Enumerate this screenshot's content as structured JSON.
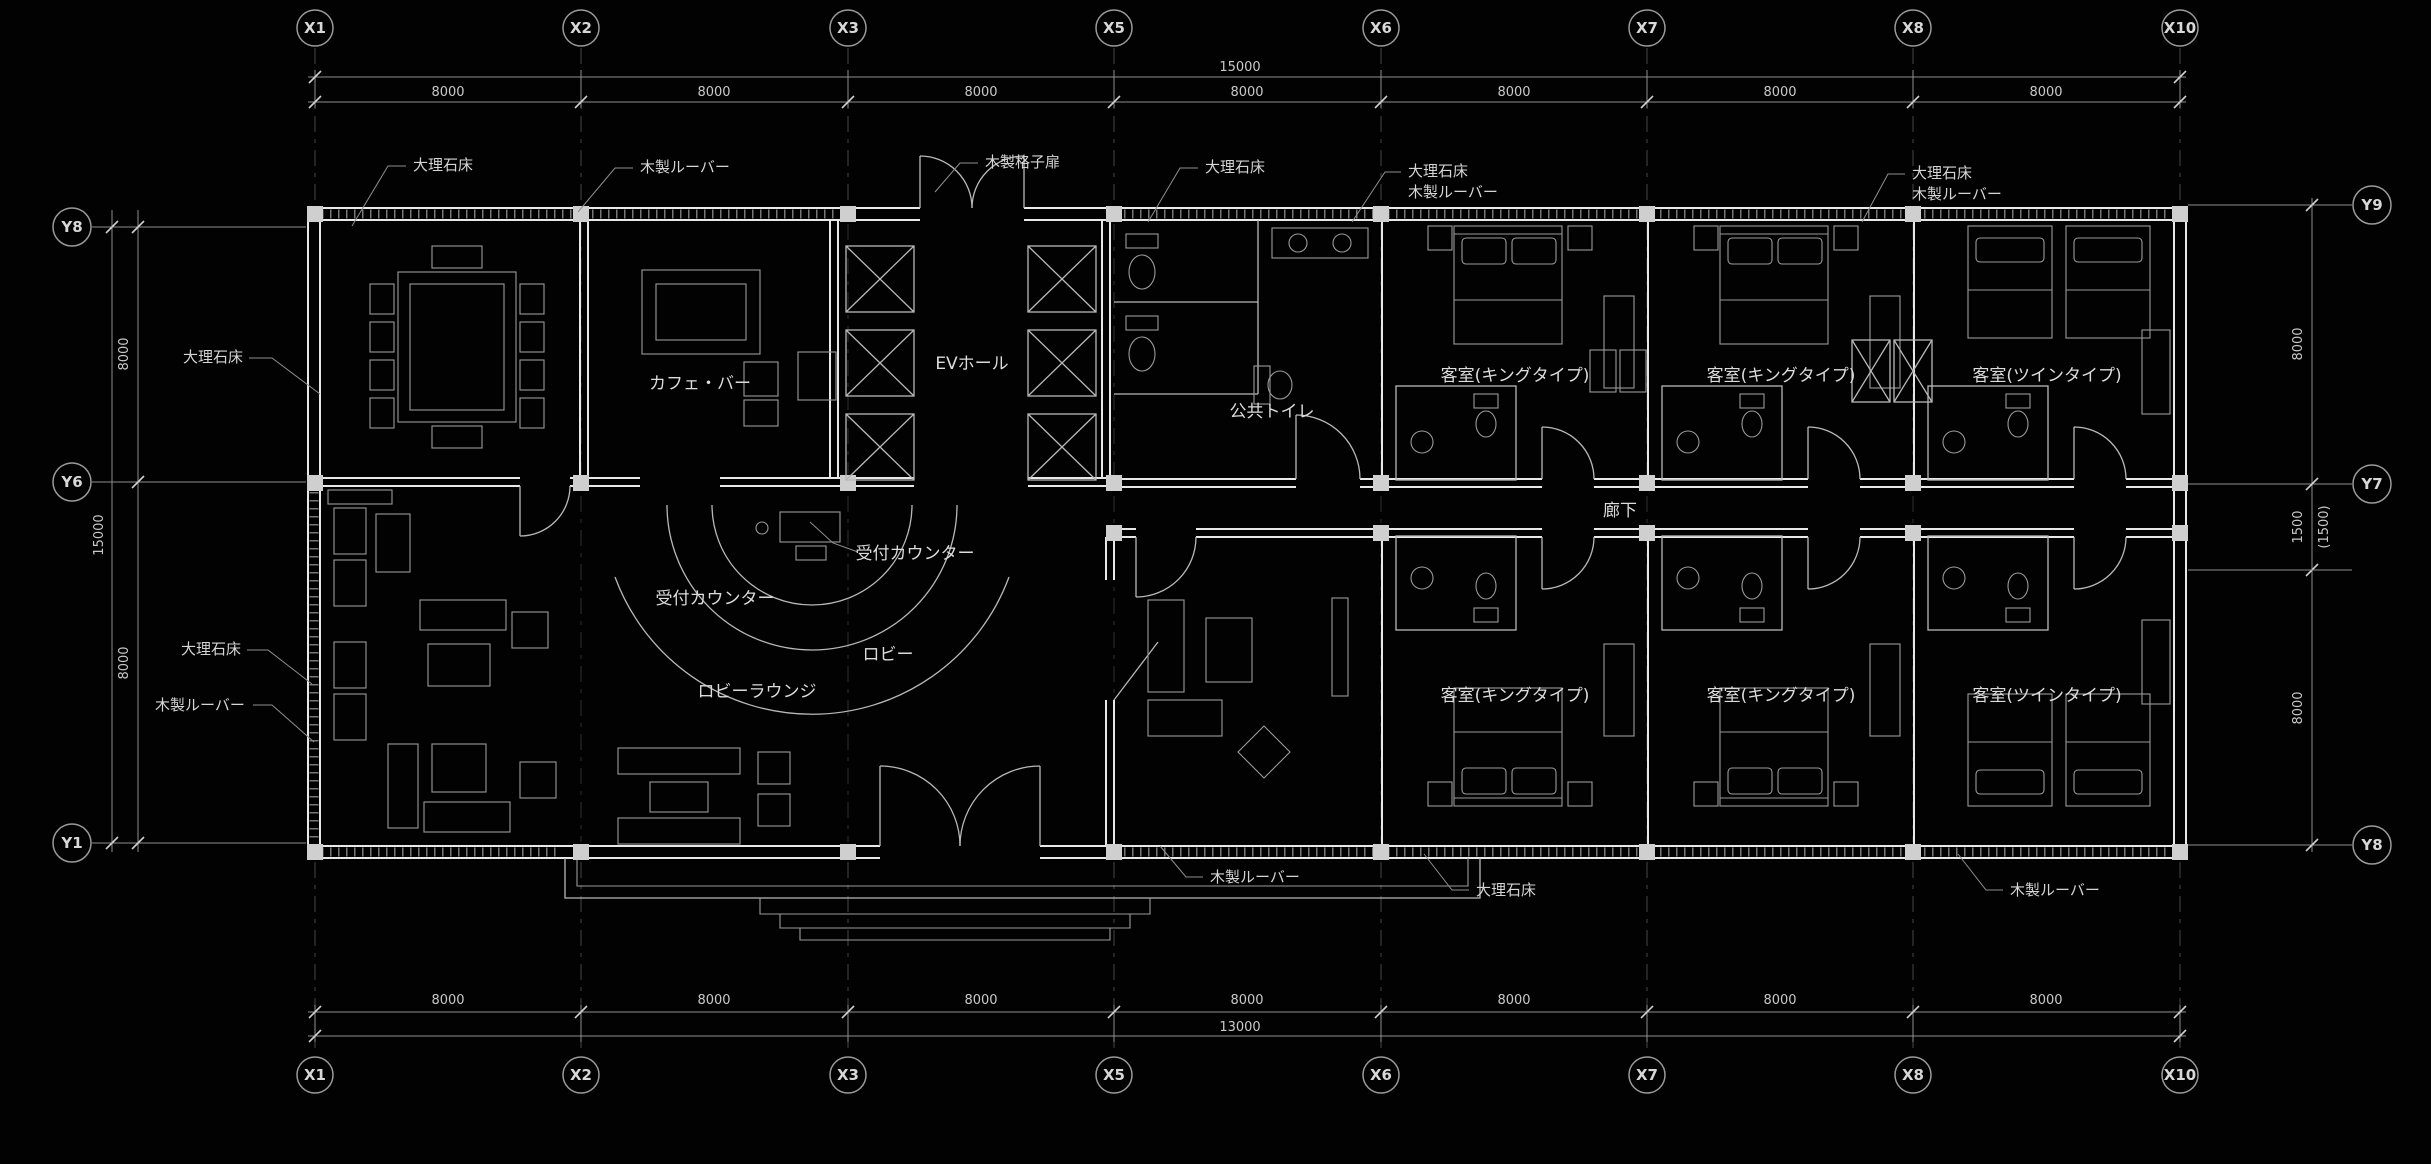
{
  "colors": {
    "background": "#020202",
    "wall_line": "#e8e8e8",
    "dim_line": "#8f8f8f",
    "text": "#dcdcdc"
  },
  "grid": {
    "x_axes": [
      "X1",
      "X2",
      "X3",
      "X5",
      "X6",
      "X7",
      "X8",
      "X10"
    ],
    "y_axes_left": [
      "Y8",
      "Y6",
      "Y1"
    ],
    "y_axes_right": [
      "Y9",
      "Y7",
      "Y8"
    ]
  },
  "dims": {
    "span": "8000",
    "top_total": "15000",
    "bottom_total": "13000",
    "left_total": "15000",
    "left_spans": [
      "8000",
      "8000"
    ],
    "right_spans": [
      "8000",
      "1500",
      "(1500)",
      "8000"
    ]
  },
  "rooms": {
    "cafe_bar": "カフェ・バー",
    "ev_hall": "EVホール",
    "public_toilet": "公共トイレ",
    "reception_counter": "受付カウンター",
    "lobby": "ロビー",
    "lobby_lounge": "ロビーラウンジ",
    "corridor": "廊下",
    "guest_room_king": "客室(キングタイプ)",
    "guest_room_twin": "客室(ツインタイプ)"
  },
  "finishes": {
    "marble_floor": "大理石床",
    "wood_louver": "木製ルーバー",
    "wood_lattice_door": "木製格子扉"
  }
}
